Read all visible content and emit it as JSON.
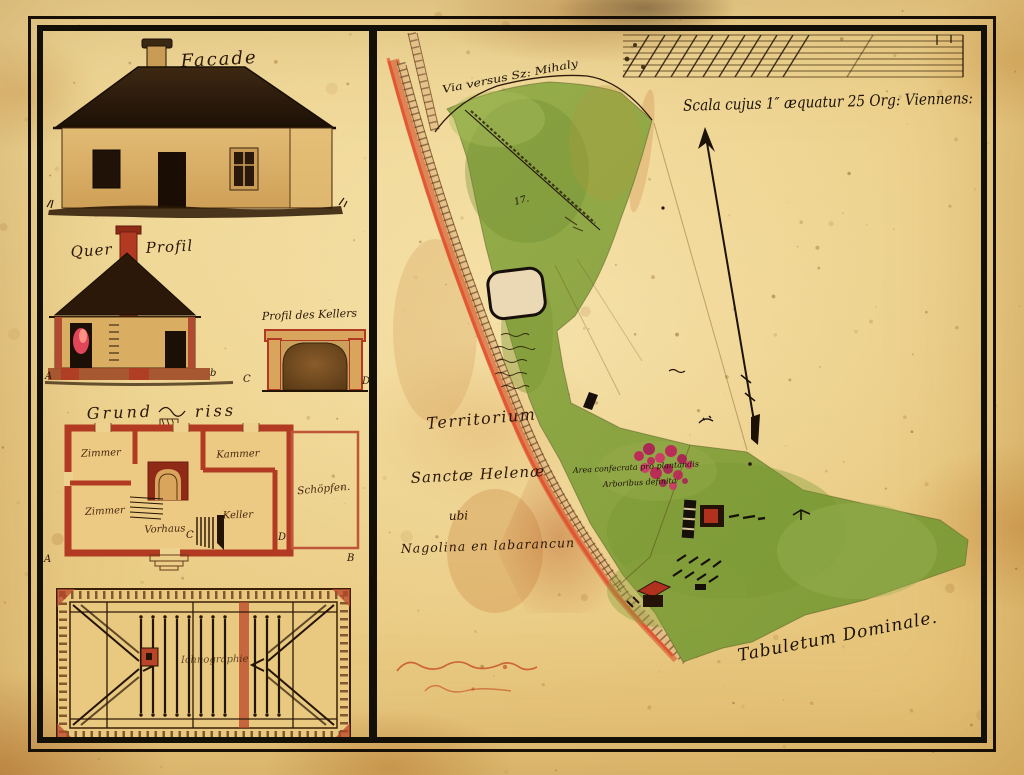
{
  "left_panel": {
    "facade_title": "Facade",
    "profile_title_left": "Quer",
    "profile_title_right": "Profil",
    "cellar_title": "Profil des Kellers",
    "plan_title_left": "Grund",
    "plan_title_right": "riss",
    "roof_label": "Ichnographie",
    "rooms": {
      "top_left": "Zimmer",
      "top_right": "Kammer",
      "bottom_left": "Zimmer",
      "keller": "Keller",
      "hall": "Vorhaus",
      "shed": "Schöpfen."
    },
    "markers": {
      "profile_a": "A",
      "profile_b": "b",
      "cellar_c": "C",
      "cellar_d": "D",
      "plan_a": "A",
      "plan_b": "B",
      "plan_c": "C",
      "plan_d": "D"
    }
  },
  "map_panel": {
    "scale_caption": "Scala cujus 1″ æquatur 25 Org: Viennens:",
    "via_label": "Via versus Sz: Mihaly",
    "territorium": {
      "line1": "Territorium",
      "line2": "Sanctæ Helenæ",
      "line3": "ubi",
      "line4": "Nagolina en labarancun"
    },
    "plantation_note": {
      "line1": "Area confecrata pro plantandis",
      "line2": "Arboribus definita"
    },
    "tabuletum_label": "Tabuletum Dominale.",
    "parcel_number": "17."
  },
  "colors": {
    "parchment": "#ecd08a",
    "ink": "#2e1a08",
    "meadow_green": "#8ca644",
    "road_red": "#db6f44",
    "plan_red": "#b23a22",
    "blossom_magenta": "#c2175b",
    "frame_black": "#151008"
  }
}
